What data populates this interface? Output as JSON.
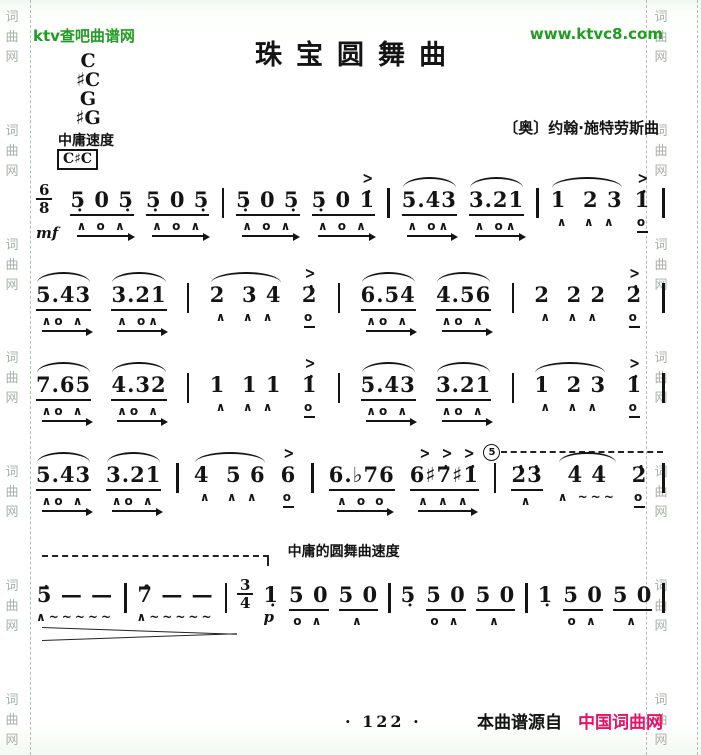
{
  "colors": {
    "site_green": "#229b22",
    "source_red": "#e81164",
    "watermark_gray": "#a8b0a8",
    "ink": "#141414"
  },
  "header": {
    "site": "ktv查吧曲谱网",
    "url": "www.ktvc8.com"
  },
  "watermark": {
    "chars": "词曲网",
    "repeat": 7
  },
  "score": {
    "title": "珠宝圆舞曲",
    "composer": "〔奥〕约翰·施特劳斯曲",
    "tempo": "中庸速度",
    "keys": [
      "C",
      "♯C",
      "G",
      "♯G"
    ],
    "key_box": "C♯C",
    "oct_label": "5",
    "waltz_label": "中庸的圆舞曲速度"
  },
  "music": {
    "lines": [
      {
        "items": [
          {
            "t": "ts",
            "top": "6",
            "bot": "8",
            "dyn": "mf"
          },
          {
            "t": "g",
            "n": "5̣ 0 5̣",
            "beam": 1,
            "m": "∧ o ∧",
            "ml": "arrow"
          },
          {
            "t": "g",
            "n": "5̣ 0 5̣",
            "beam": 1,
            "m": "∧ o ∧",
            "ml": "arrow"
          },
          {
            "t": "bar"
          },
          {
            "t": "g",
            "n": "5̣ 0 5̣",
            "beam": 1,
            "m": "∧ o ∧",
            "ml": "arrow"
          },
          {
            "t": "g",
            "n": "5̣ 0 1̇",
            "beam": 1,
            "acc": 1,
            "m": "∧ o ∧",
            "ml": "arrow"
          },
          {
            "t": "bar"
          },
          {
            "t": "g",
            "n": "5.43",
            "slur": 1,
            "beam": 1,
            "m": "∧ o∧",
            "ml": "arrow"
          },
          {
            "t": "g",
            "n": "3.21",
            "slur": 1,
            "beam": 1,
            "m": "∧ o∧",
            "ml": "arrow"
          },
          {
            "t": "bar"
          },
          {
            "t": "g",
            "n": "1  2 3",
            "slur": 1,
            "m": "∧  ∧ ∧"
          },
          {
            "t": "g",
            "n": "1̇",
            "acc": 1,
            "m": "o",
            "ml": "line"
          },
          {
            "t": "bar"
          }
        ]
      },
      {
        "items": [
          {
            "t": "g",
            "n": "5.43",
            "slur": 1,
            "beam": 1,
            "m": "∧o ∧",
            "ml": "arrow"
          },
          {
            "t": "g",
            "n": "3.21",
            "slur": 1,
            "beam": 1,
            "m": "∧ o∧",
            "ml": "arrow"
          },
          {
            "t": "bar"
          },
          {
            "t": "g",
            "n": "2  3 4",
            "slur": 1,
            "m": "∧  ∧ ∧"
          },
          {
            "t": "g",
            "n": "2̇",
            "acc": 1,
            "m": "o",
            "ml": "line"
          },
          {
            "t": "bar"
          },
          {
            "t": "g",
            "n": "6.54",
            "slur": 1,
            "beam": 1,
            "m": "∧o ∧",
            "ml": "arrow"
          },
          {
            "t": "g",
            "n": "4.56",
            "slur": 1,
            "beam": 1,
            "m": "∧o ∧",
            "ml": "arrow"
          },
          {
            "t": "bar"
          },
          {
            "t": "g",
            "n": "2  2 2",
            "m": "∧  ∧ ∧"
          },
          {
            "t": "g",
            "n": "2̇",
            "acc": 1,
            "m": "o",
            "ml": "line"
          },
          {
            "t": "bar"
          }
        ]
      },
      {
        "items": [
          {
            "t": "g",
            "n": "7.65",
            "slur": 1,
            "beam": 1,
            "m": "∧o ∧",
            "ml": "arrow"
          },
          {
            "t": "g",
            "n": "4.32",
            "slur": 1,
            "beam": 1,
            "m": "∧o ∧",
            "ml": "arrow"
          },
          {
            "t": "bar"
          },
          {
            "t": "g",
            "n": "1  1 1",
            "m": "∧  ∧ ∧"
          },
          {
            "t": "g",
            "n": "1̇",
            "acc": 1,
            "m": "o",
            "ml": "line"
          },
          {
            "t": "bar"
          },
          {
            "t": "g",
            "n": "5.43",
            "slur": 1,
            "beam": 1,
            "m": "∧o ∧",
            "ml": "arrow"
          },
          {
            "t": "g",
            "n": "3.21",
            "slur": 1,
            "beam": 1,
            "m": "∧o ∧",
            "ml": "arrow"
          },
          {
            "t": "bar"
          },
          {
            "t": "g",
            "n": "1  2 3",
            "slur": 1,
            "m": "∧  ∧ ∧"
          },
          {
            "t": "g",
            "n": "1̇",
            "acc": 1,
            "m": "o",
            "ml": "line"
          },
          {
            "t": "bar"
          }
        ]
      },
      {
        "cls": "line4",
        "overlays": [
          {
            "cls": "oct-line",
            "label": "5"
          }
        ],
        "items": [
          {
            "t": "g",
            "n": "5.43",
            "slur": 1,
            "beam": 1,
            "m": "∧o ∧",
            "ml": "arrow"
          },
          {
            "t": "g",
            "n": "3.21",
            "slur": 1,
            "beam": 1,
            "m": "∧o ∧",
            "ml": "arrow"
          },
          {
            "t": "bar"
          },
          {
            "t": "g",
            "n": "4  5 6",
            "slur": 1,
            "m": "∧  ∧ ∧"
          },
          {
            "t": "g",
            "n": "6",
            "acc": 1,
            "m": "o",
            "ml": "line"
          },
          {
            "t": "bar"
          },
          {
            "t": "g",
            "n": "6.♭76",
            "beam": 1,
            "m": "∧ o o",
            "ml": "arrow"
          },
          {
            "t": "g",
            "n": "6♯7̇♯1̇",
            "beam": 1,
            "accs": 3,
            "m": "∧ ∧ ∧",
            "ml": "arrow"
          },
          {
            "t": "bar"
          },
          {
            "t": "g",
            "n": "2̇3̇",
            "beam": 1,
            "m": "∧"
          },
          {
            "t": "g",
            "n": "4̇ 4̇",
            "slur": 1,
            "m": "∧ ~~~"
          },
          {
            "t": "g",
            "n": "2̇",
            "m": "o",
            "ml": "line"
          },
          {
            "t": "bar"
          }
        ]
      },
      {
        "cls": "line5",
        "label": "中庸的圆舞曲速度",
        "overlays": [
          {
            "cls": "dash-top"
          },
          {
            "cls": "hairpin"
          }
        ],
        "items": [
          {
            "t": "g",
            "n": "5̇ — —",
            "m": "∧~~~~~"
          },
          {
            "t": "bar"
          },
          {
            "t": "g",
            "n": "7̂ — —",
            "m": "∧~~~~~"
          },
          {
            "t": "bar"
          },
          {
            "t": "ts",
            "top": "3",
            "bot": "4"
          },
          {
            "t": "g",
            "n": "1̣",
            "dyn": "p",
            "m": ""
          },
          {
            "t": "g",
            "n": "5 0",
            "beam": 1,
            "m": "o ∧"
          },
          {
            "t": "g",
            "n": "5 0",
            "beam": 1,
            "m": "∧"
          },
          {
            "t": "bar"
          },
          {
            "t": "g",
            "n": "5̣",
            "m": ""
          },
          {
            "t": "g",
            "n": "5 0",
            "beam": 1,
            "m": "o ∧"
          },
          {
            "t": "g",
            "n": "5 0",
            "beam": 1,
            "m": "∧"
          },
          {
            "t": "bar"
          },
          {
            "t": "g",
            "n": "1̣",
            "m": ""
          },
          {
            "t": "g",
            "n": "5 0",
            "beam": 1,
            "m": "o ∧"
          },
          {
            "t": "g",
            "n": "5 0",
            "beam": 1,
            "m": "∧"
          },
          {
            "t": "bar"
          }
        ]
      }
    ]
  },
  "footer": {
    "page_no": "· 122 ·",
    "source_prefix": "本曲谱源自",
    "source_name": "中国词曲网"
  }
}
